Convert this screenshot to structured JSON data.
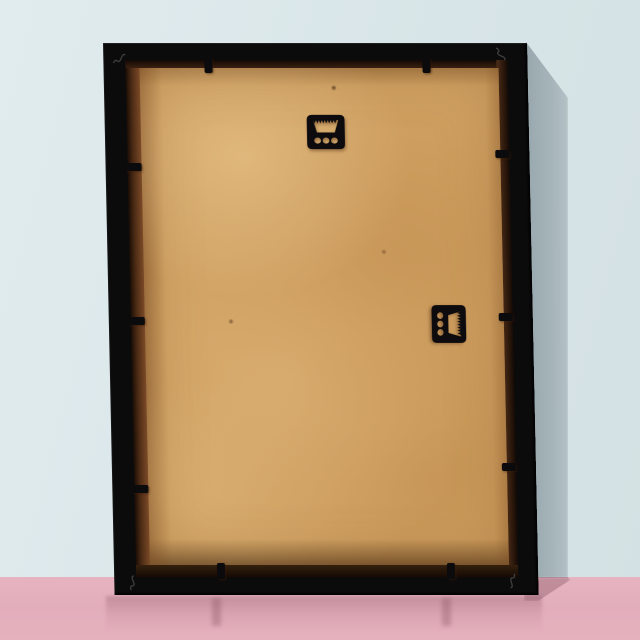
{
  "meta": {
    "type": "product-photo",
    "subject": "back-of-empty-black-picture-frame-standing-on-floor-against-wall"
  },
  "palette": {
    "wall": "#d8e5e8",
    "floor": "#e3aebb",
    "wall_shadow": "#a2b0b6",
    "floor_shadow": "#c9a2b0",
    "frame_black": "#0c0b0c",
    "rabbet_brown": "#7c4a27",
    "backing_tan": "#cfa162",
    "backing_tan_light": "#e0b77c",
    "backing_tan_dark": "#b5824a",
    "hardware_black": "#0b0a0c"
  },
  "scene": {
    "horizon_y": 577,
    "light_direction": "upper-left",
    "shadow_side": "right"
  },
  "frame": {
    "outer_px": {
      "left": 103,
      "top": 43,
      "width": 424,
      "height": 552
    },
    "lean_skew_deg": 1.2,
    "border_px": {
      "top": 17,
      "right": 20,
      "bottom": 18,
      "left": 22
    }
  },
  "hardware": [
    {
      "id": "hanger-top",
      "type": "sawtooth-hanger",
      "orientation": "teeth-up",
      "local_px": {
        "left": 200,
        "top": 70,
        "width": 42,
        "height": 38
      }
    },
    {
      "id": "hanger-right",
      "type": "sawtooth-hanger",
      "orientation": "teeth-right",
      "local_px": {
        "left": 319,
        "top": 258,
        "width": 38,
        "height": 42
      }
    }
  ],
  "retainer_tabs": [
    {
      "side": "top",
      "x": 101
    },
    {
      "side": "top",
      "x": 319
    },
    {
      "side": "bottom",
      "x": 103
    },
    {
      "side": "bottom",
      "x": 333
    },
    {
      "side": "left",
      "y": 120
    },
    {
      "side": "left",
      "y": 274
    },
    {
      "side": "left",
      "y": 442
    },
    {
      "side": "right",
      "y": 107
    },
    {
      "side": "right",
      "y": 270
    },
    {
      "side": "right",
      "y": 420
    }
  ],
  "corner_marks": [
    {
      "corner": "top-left",
      "x": 8,
      "y": 7,
      "rot": 0
    },
    {
      "corner": "top-right",
      "x": 392,
      "y": 5,
      "rot": 90
    },
    {
      "corner": "bottom-left",
      "x": 8,
      "y": 532,
      "rot": -45
    },
    {
      "corner": "bottom-right",
      "x": 392,
      "y": 534,
      "rot": 140
    }
  ],
  "tab_reflections": [
    {
      "x": 212
    },
    {
      "x": 442
    }
  ]
}
